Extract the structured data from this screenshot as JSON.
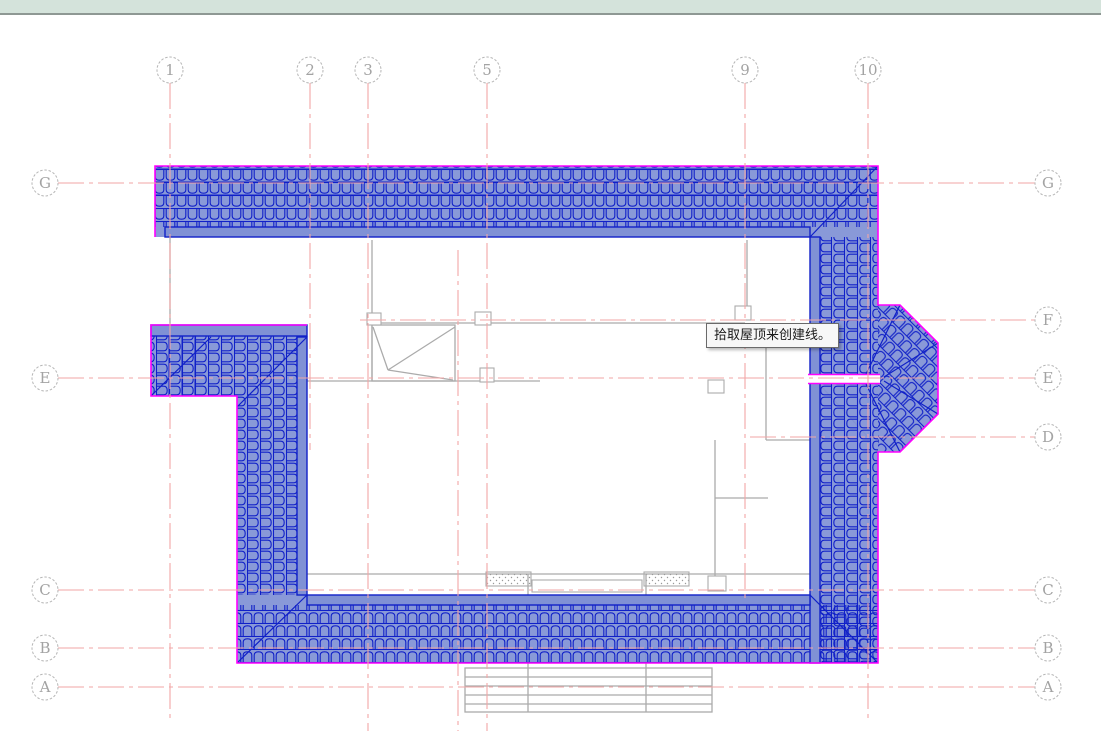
{
  "app": {
    "name": "cad-roof-plan-view"
  },
  "tooltip": {
    "text": "拾取屋顶来创建线。"
  },
  "colors": {
    "topbar_bg": "#d4e3db",
    "grid_line_pink": "#f2a6a6",
    "bubble_stroke": "#b6b6b6",
    "bubble_text": "#a3a3a3",
    "roof_selection_fill": "#8091d5",
    "roof_tile_line": "#1020c8",
    "roof_selection_outline": "#ff00ff",
    "underlay_gray": "#ababab",
    "canvas_bg": "#ffffff"
  },
  "grid_system": {
    "columns": [
      {
        "label": "1",
        "x": 170,
        "line_end": 718
      },
      {
        "label": "2",
        "x": 310,
        "line_end": 450
      },
      {
        "label": "3",
        "x": 368,
        "line_end": 731
      },
      {
        "label": "5",
        "x": 487,
        "line_end": 731
      },
      {
        "label": "9",
        "x": 745,
        "line_end": 598
      },
      {
        "label": "10",
        "x": 868,
        "line_end": 718
      }
    ],
    "unlabeled_columns": [
      {
        "x": 458,
        "y1": 250,
        "y2": 731
      }
    ],
    "rows": [
      {
        "label": "G",
        "y": 183,
        "has_left_bubble": true,
        "x_start": 58
      },
      {
        "label": "F",
        "y": 320,
        "has_left_bubble": false,
        "x_start": 360
      },
      {
        "label": "E",
        "y": 378,
        "has_left_bubble": true,
        "x_start": 58
      },
      {
        "label": "D",
        "y": 437,
        "has_left_bubble": false,
        "x_start": 750
      },
      {
        "label": "C",
        "y": 590,
        "has_left_bubble": true,
        "x_start": 58
      },
      {
        "label": "B",
        "y": 648,
        "has_left_bubble": true,
        "x_start": 58
      },
      {
        "label": "A",
        "y": 687,
        "has_left_bubble": true,
        "x_start": 58
      }
    ],
    "bubble_radius": 13,
    "top_bubble_cy": 70,
    "left_bubble_cx": 45,
    "right_bubble_cx": 1048,
    "row_line_x_end": 1035
  }
}
